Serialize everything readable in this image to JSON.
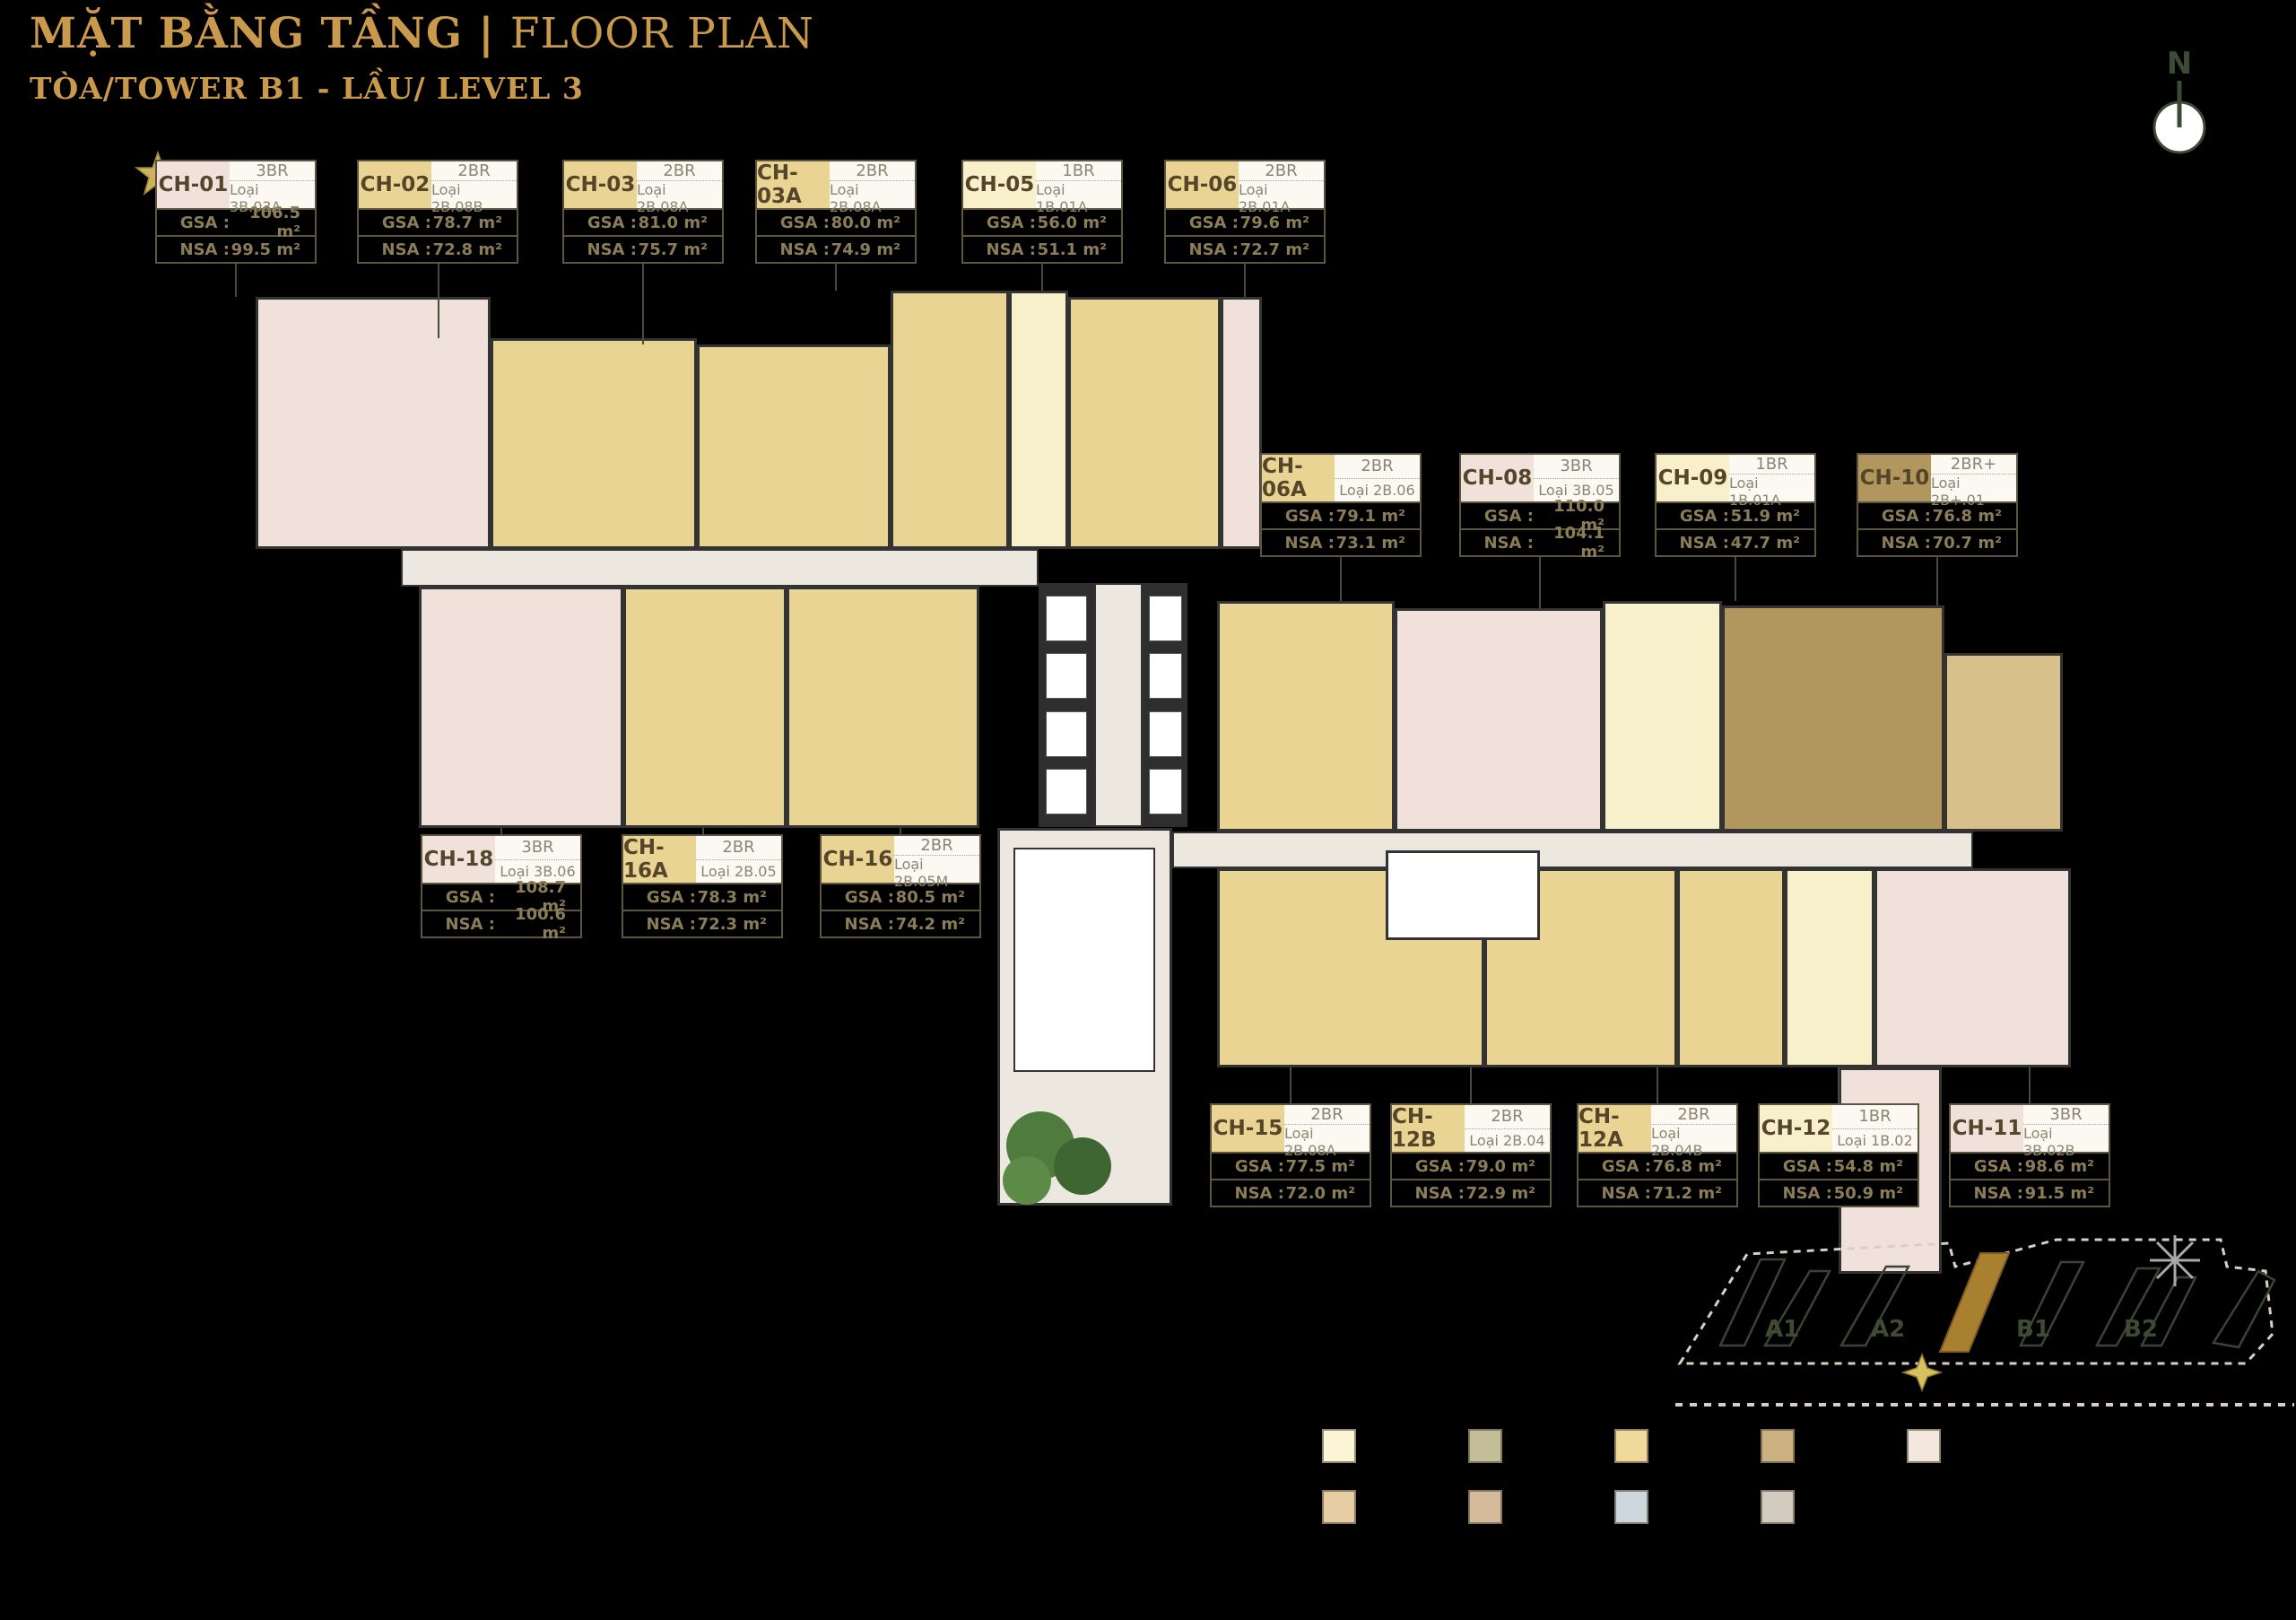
{
  "page": {
    "title_vi": "MẶT BẰNG TẦNG",
    "title_sep": "|",
    "title_en": "FLOOR PLAN",
    "subtitle": "TÒA/TOWER B1 - LẦU/ LEVEL 3",
    "north_label": "N"
  },
  "labels": {
    "gsa": "GSA :",
    "nsa": "NSA :"
  },
  "units": [
    {
      "id": "CH-01",
      "type": "3BR",
      "loai": "Loại 3B.03A",
      "gsa": "106.5 m²",
      "nsa": "99.5 m²",
      "color_key": "pink"
    },
    {
      "id": "CH-02",
      "type": "2BR",
      "loai": "Loại 2B.08B",
      "gsa": "78.7 m²",
      "nsa": "72.8 m²",
      "color_key": "gold"
    },
    {
      "id": "CH-03",
      "type": "2BR",
      "loai": "Loại 2B.08A",
      "gsa": "81.0 m²",
      "nsa": "75.7 m²",
      "color_key": "gold"
    },
    {
      "id": "CH-03A",
      "type": "2BR",
      "loai": "Loại 2B.08A",
      "gsa": "80.0 m²",
      "nsa": "74.9 m²",
      "color_key": "gold"
    },
    {
      "id": "CH-05",
      "type": "1BR",
      "loai": "Loại 1B.01A",
      "gsa": "56.0 m²",
      "nsa": "51.1 m²",
      "color_key": "cream"
    },
    {
      "id": "CH-06",
      "type": "2BR",
      "loai": "Loại 2B.01A",
      "gsa": "79.6 m²",
      "nsa": "72.7 m²",
      "color_key": "gold"
    },
    {
      "id": "CH-06A",
      "type": "2BR",
      "loai": "Loại 2B.06",
      "gsa": "79.1 m²",
      "nsa": "73.1 m²",
      "color_key": "gold"
    },
    {
      "id": "CH-08",
      "type": "3BR",
      "loai": "Loại 3B.05",
      "gsa": "110.0 m²",
      "nsa": "104.1 m²",
      "color_key": "pink"
    },
    {
      "id": "CH-09",
      "type": "1BR",
      "loai": "Loại 1B.01A",
      "gsa": "51.9 m²",
      "nsa": "47.7 m²",
      "color_key": "cream"
    },
    {
      "id": "CH-10",
      "type": "2BR+",
      "loai": "Loại 2B+.01",
      "gsa": "76.8 m²",
      "nsa": "70.7 m²",
      "color_key": "brown"
    },
    {
      "id": "CH-18",
      "type": "3BR",
      "loai": "Loại 3B.06",
      "gsa": "108.7 m²",
      "nsa": "100.6 m²",
      "color_key": "pink"
    },
    {
      "id": "CH-16A",
      "type": "2BR",
      "loai": "Loại 2B.05",
      "gsa": "78.3 m²",
      "nsa": "72.3 m²",
      "color_key": "gold"
    },
    {
      "id": "CH-16",
      "type": "2BR",
      "loai": "Loại 2B.05M",
      "gsa": "80.5 m²",
      "nsa": "74.2 m²",
      "color_key": "gold"
    },
    {
      "id": "CH-15",
      "type": "2BR",
      "loai": "Loại 2B.08A",
      "gsa": "77.5 m²",
      "nsa": "72.0 m²",
      "color_key": "gold"
    },
    {
      "id": "CH-12B",
      "type": "2BR",
      "loai": "Loại 2B.04",
      "gsa": "79.0 m²",
      "nsa": "72.9 m²",
      "color_key": "gold"
    },
    {
      "id": "CH-12A",
      "type": "2BR",
      "loai": "Loại 2B.04B",
      "gsa": "76.8 m²",
      "nsa": "71.2 m²",
      "color_key": "gold"
    },
    {
      "id": "CH-12",
      "type": "1BR",
      "loai": "Loại 1B.02",
      "gsa": "54.8 m²",
      "nsa": "50.9 m²",
      "color_key": "cream"
    },
    {
      "id": "CH-11",
      "type": "3BR",
      "loai": "Loại 3B.02B",
      "gsa": "98.6 m²",
      "nsa": "91.5 m²",
      "color_key": "pink"
    }
  ],
  "minimap": {
    "towers": [
      "A1",
      "A2",
      "B1",
      "B2"
    ],
    "highlighted": "B1"
  },
  "legend": {
    "row1": [
      "#FBF5D5",
      "#C3BE97",
      "#F0DA9B",
      "#CBB280",
      "#F4E7DD"
    ],
    "row2": [
      "#E6CCA3",
      "#D5BB9C",
      "#CDD5DD",
      "#D2CCC0"
    ]
  },
  "colors": {
    "title_gold": "#C9994C",
    "gold": "#EAD494",
    "gold2": "#D8C08A",
    "pink": "#F0E2DB",
    "cream": "#F8F0CB",
    "brown": "#B1975E",
    "corridor": "#ECE8DF",
    "lobby": "#ECE8DF",
    "wall": "#333333",
    "connector_green": "#3F4E3F",
    "card_border": "#5E563C",
    "minimap_outline": "#3A4435",
    "minimap_gold": "#A9802F",
    "star_gold": "#CDB45C",
    "compass_gray": "#A8A8A5",
    "north_green": "#3C4A36"
  }
}
